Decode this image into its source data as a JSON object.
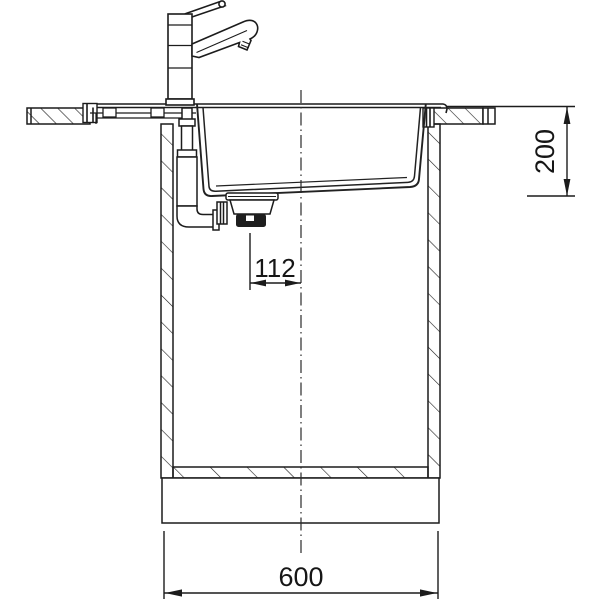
{
  "drawing": {
    "type": "technical-cross-section",
    "subject": "Kitchen sink, faucet and base cabinet installation drawing, sectional side view",
    "background_color": "#ffffff",
    "line_color": "#1c1c1c",
    "dimensions": {
      "basin_depth": {
        "value": "200",
        "orientation": "vertical",
        "position": "right"
      },
      "drain_offset_from_center": {
        "value": "112",
        "orientation": "horizontal",
        "position": "middle"
      },
      "cabinet_width": {
        "value": "600",
        "orientation": "horizontal",
        "position": "bottom"
      }
    },
    "components": [
      "single-lever-faucet",
      "countertop-left",
      "countertop-right",
      "sink-rim",
      "sink-basin",
      "overflow-pipe",
      "drain-assembly",
      "cabinet-left-wall",
      "cabinet-right-wall",
      "cabinet-bottom-panel",
      "plinth",
      "vertical-center-line"
    ]
  }
}
